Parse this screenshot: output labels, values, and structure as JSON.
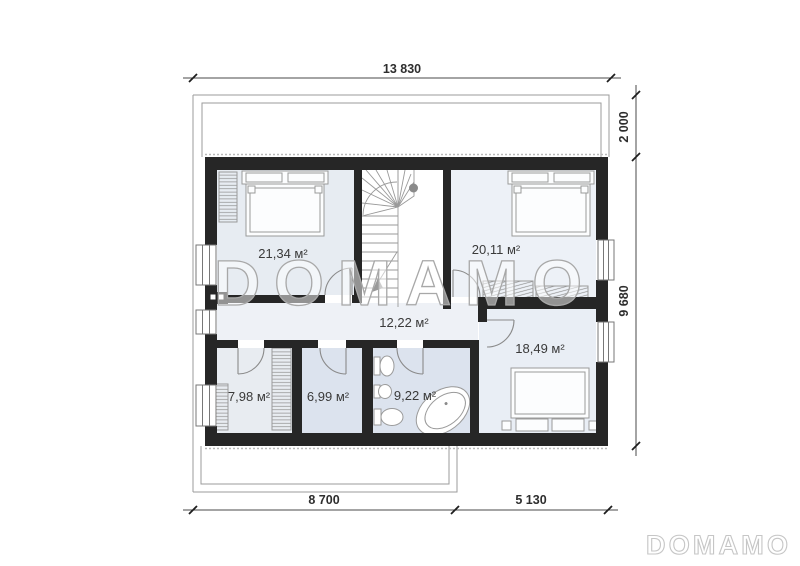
{
  "watermark": {
    "text": "DOMAMO"
  },
  "brand_logo": {
    "text": "DOMAMO"
  },
  "floor_plan": {
    "rooms": [
      {
        "name": "bedroom-top-left",
        "area_label": "21,34 м²"
      },
      {
        "name": "bedroom-top-right",
        "area_label": "20,11 м²"
      },
      {
        "name": "hallway",
        "area_label": "12,22 м²"
      },
      {
        "name": "bedroom-bottom-right",
        "area_label": "18,49 м²"
      },
      {
        "name": "wardrobe-room",
        "area_label": "7,98 м²"
      },
      {
        "name": "utility-room",
        "area_label": "6,99 м²"
      },
      {
        "name": "bathroom",
        "area_label": "9,22 м²"
      }
    ],
    "dimensions": {
      "overall_width": "13 830",
      "roof_overhang_depth": "2 000",
      "body_depth": "9 680",
      "bottom_left_width": "8 700",
      "bottom_right_width": "5 130"
    },
    "colors": {
      "wall": "#262626",
      "floor_light": "#e7ecf2",
      "floor_blue": "#dce3ee",
      "hallway_floor": "#eef1f6",
      "line_gray": "#8a8a8a"
    }
  }
}
